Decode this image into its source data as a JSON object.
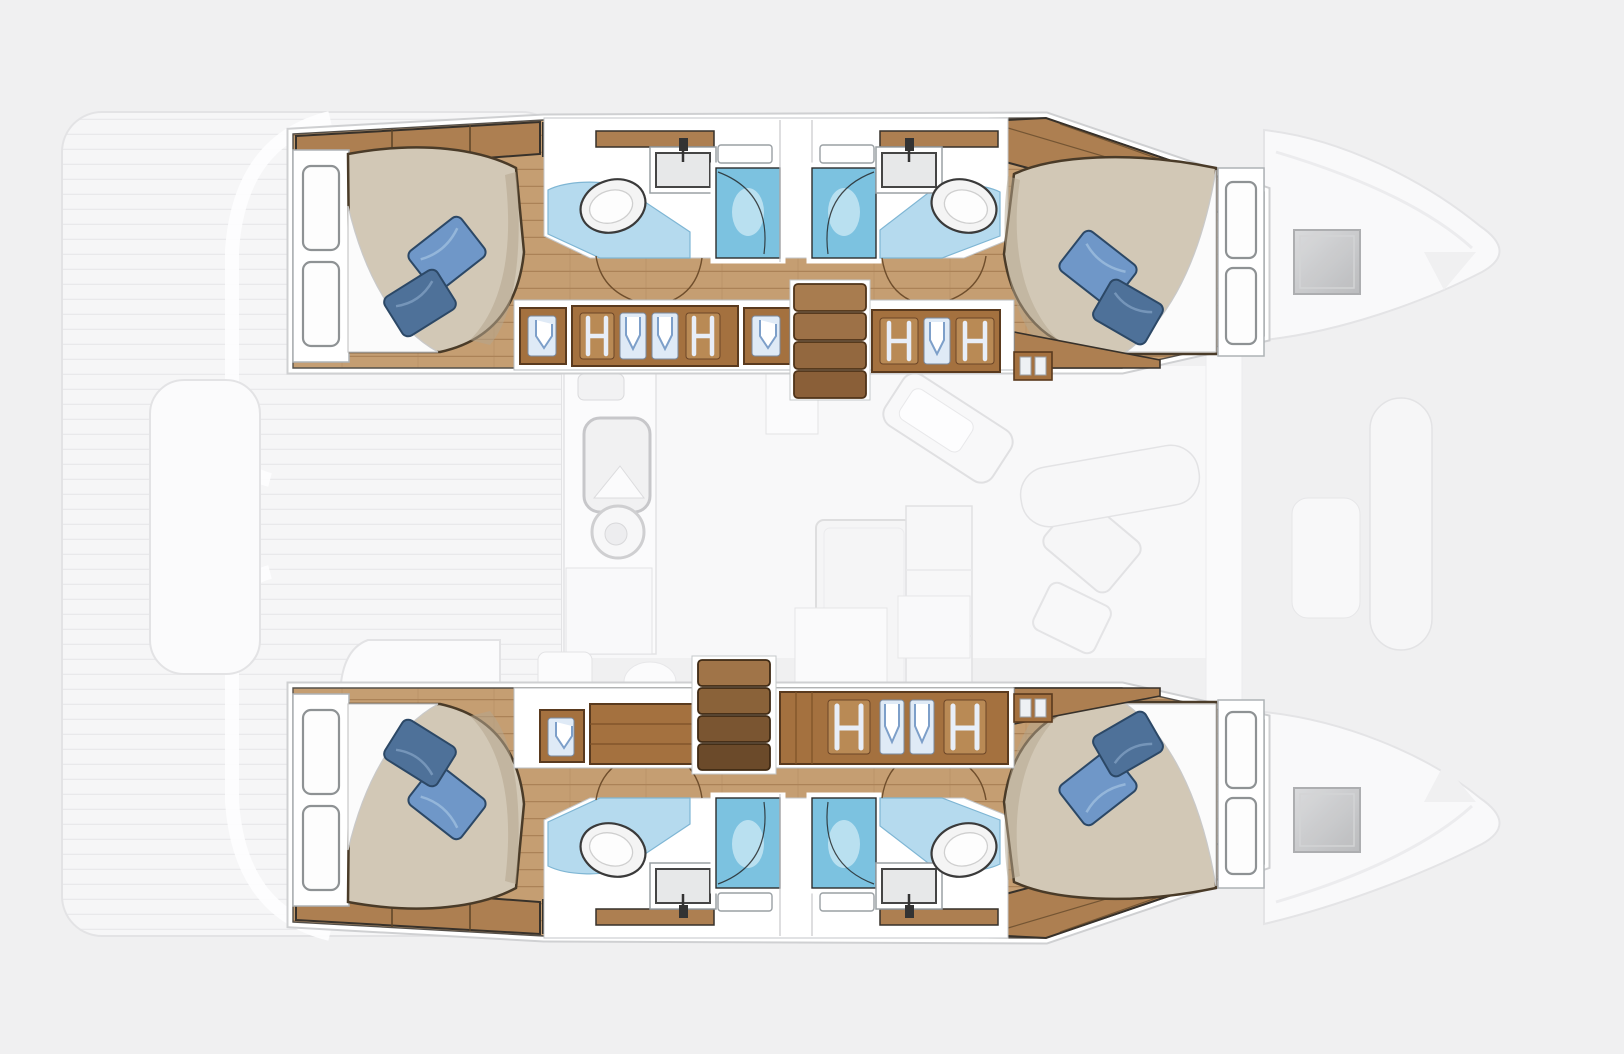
{
  "scene": {
    "type": "catamaran-interior-floorplan",
    "description": "Top-down floor plan of a 4-cabin / 4-head catamaran: two sharp hull interiors with double beds, wardrobes and bathrooms, faded saloon, aft deck and bows"
  },
  "counts": {
    "hulls": 2,
    "cabins": 4,
    "beds": 4,
    "pillows": 8,
    "bathrooms": 4,
    "toilets": 4,
    "sinks": 4,
    "showers": 4,
    "companionway_stairs": 2,
    "bow_hatches": 2,
    "wardrobe_lockers": 10
  },
  "legend": [
    "aft-cabin-bed",
    "forward-cabin-bed",
    "pillow",
    "headboard-shelves",
    "toilet",
    "sink",
    "shower-stall",
    "shower-door",
    "bathroom-floor",
    "wardrobe-locker",
    "hanger-panel",
    "companionway-stairs",
    "vent-grille",
    "bow-deck-hatch",
    "galley-sink",
    "galley-stove",
    "saloon-table",
    "saloon-sofa",
    "chaise-cushion",
    "aft-deck-planks"
  ],
  "palette": {
    "bg": "#f0f0f1",
    "ghostFill": "#f6f6f7",
    "ghostFill2": "#fbfbfc",
    "ghostStroke": "#e3e3e5",
    "plankLine": "#e9e9eb",
    "saloonFloor": "#f8f8f9",
    "white": "#ffffff",
    "frameGray": "#9aa0a4",
    "outlineDark": "#37312a",
    "wood": "#c59e72",
    "woodLine": "#ab8257",
    "woodBand": "#ad7f51",
    "woodDark": "#8a5c36",
    "lockerWood": "#a4713f",
    "stairLight": "#a87c4f",
    "stairDark": "#6b4a2a",
    "duvet": "#d2c8b6",
    "duvetShadow": "#b4a58e",
    "sheet": "#fbfbfb",
    "pillowLight": "#6f97c8",
    "pillowDark": "#4e7199",
    "pillowOutline": "#2c4866",
    "bathFloor": "#b5daee",
    "shower": "#7cc2e0",
    "showerGlow": "#cdeaf6",
    "fixture": "#f4f4f4",
    "fixtureStroke": "#454545",
    "sinkInner": "#e7e8e9",
    "ventGray": "#c2c3c5",
    "ventDark": "#8f9092",
    "hatchLight": "#d8d9db",
    "hatchDark": "#b6b7b9",
    "panelBg": "#dfeaf6",
    "hangerBlue": "#7d9fc9"
  }
}
